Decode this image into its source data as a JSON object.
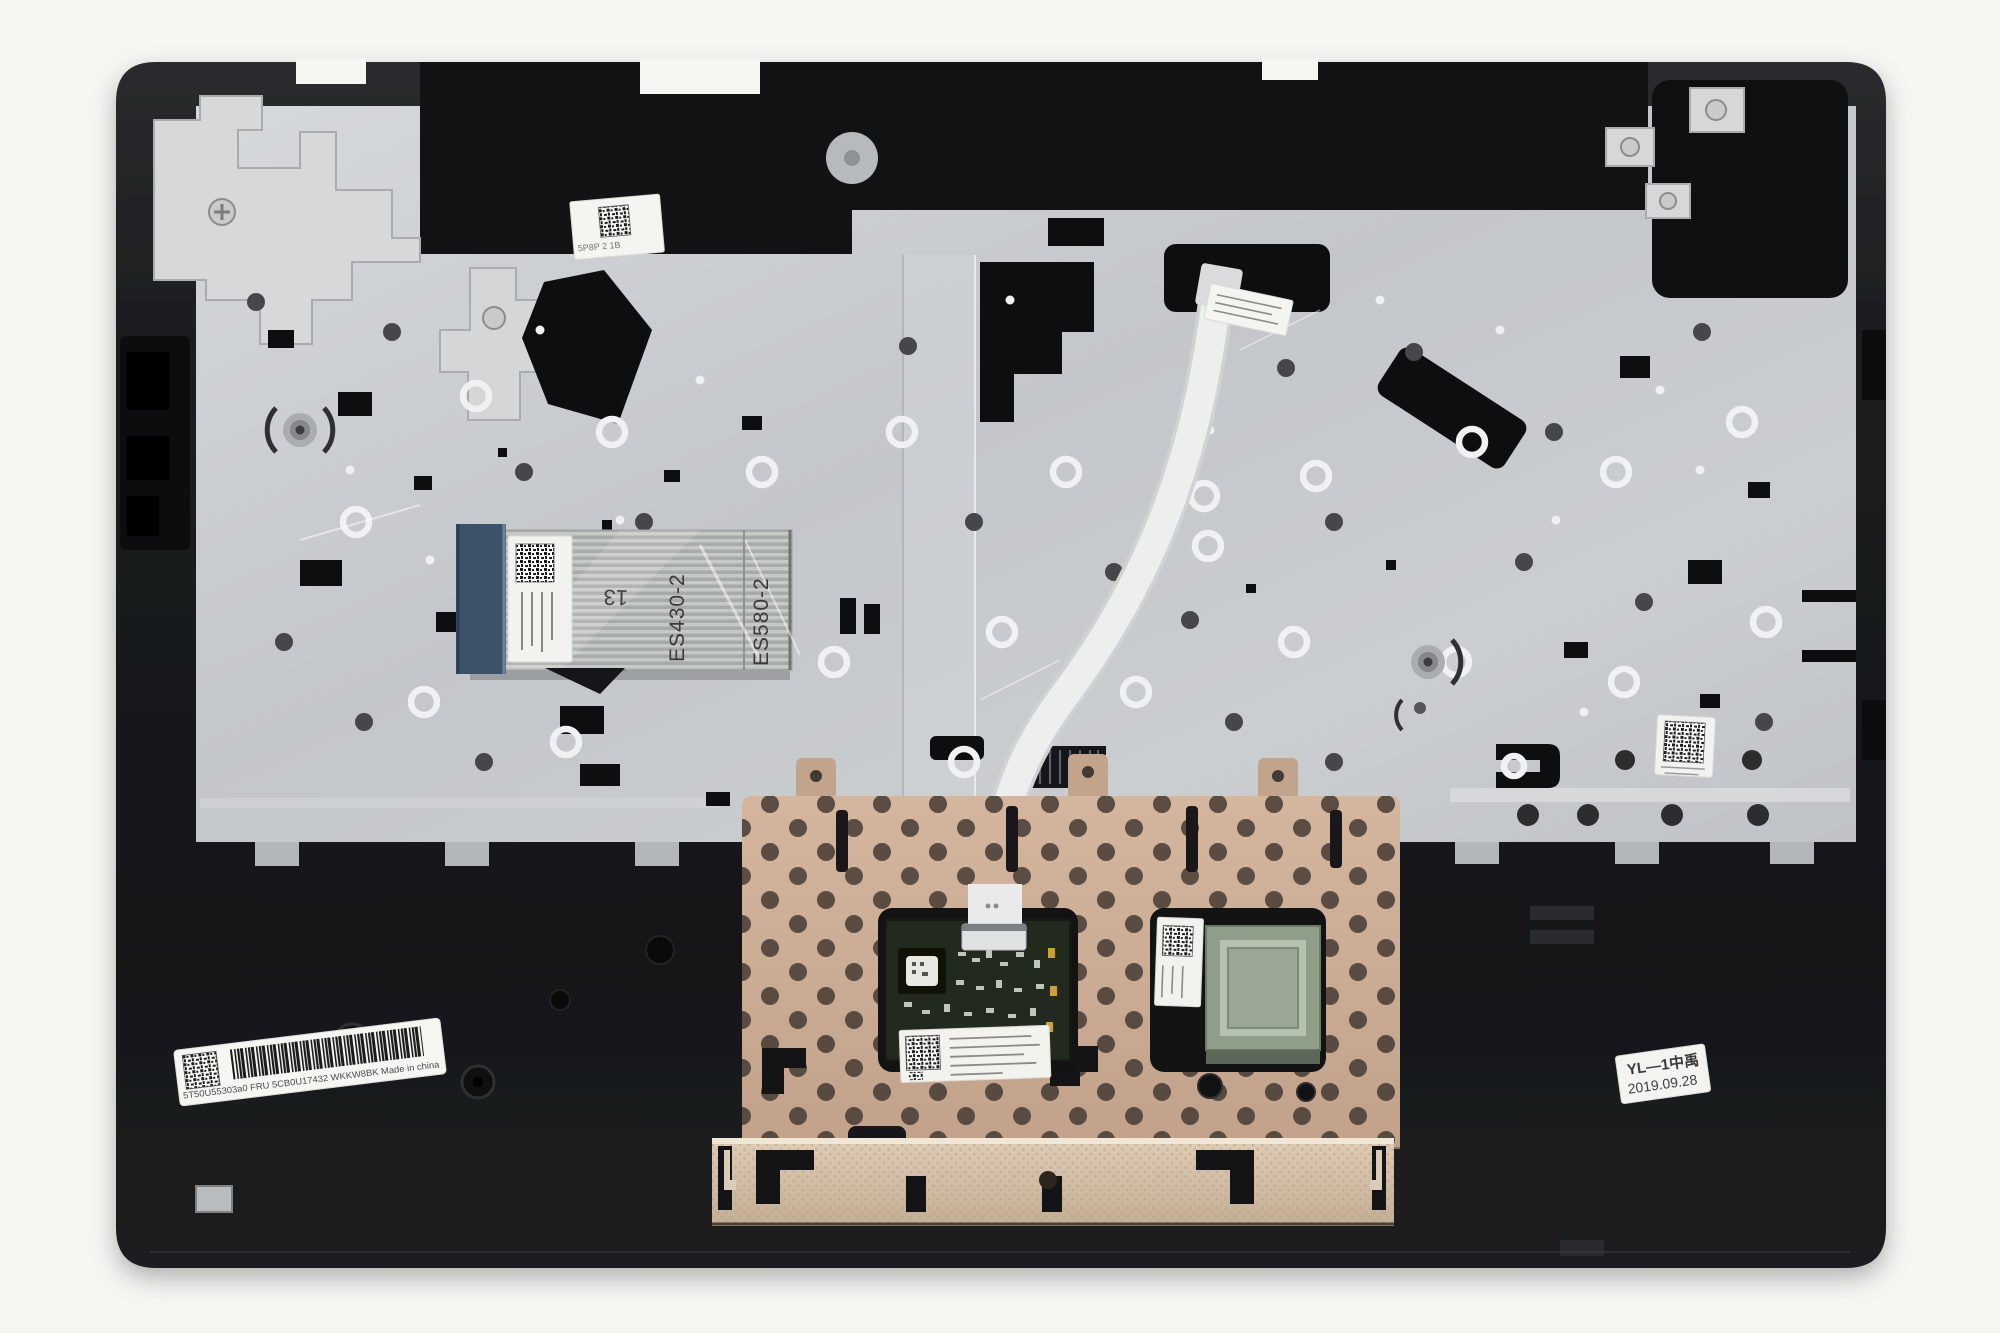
{
  "meta": {
    "type": "product-photo",
    "subject": "Laptop palmrest top-case assembly, underside view, with keyboard support plate, ribbon cables and touchpad module"
  },
  "palette": {
    "background": "#f4f6f2",
    "case_black": "#1e1f21",
    "plate_gray": "#c7cacd",
    "touchpad_tan": "#c9ab94",
    "cable_stiffener_blue": "#3d5169",
    "label_white": "#f5f5f2"
  },
  "stickers": {
    "barcode": {
      "text": "5T50U55303a0    FRU 5CB0U17432    WKKW8BK   Made in china"
    },
    "date": {
      "line1": "YL—1中禹",
      "line2": "2019.09.28"
    },
    "top_left": {
      "text": "5P8P 2 1B"
    }
  },
  "markings": {
    "cable_code_a": "ES430-2",
    "cable_code_b": "ES580-2",
    "cable_number": "13"
  }
}
